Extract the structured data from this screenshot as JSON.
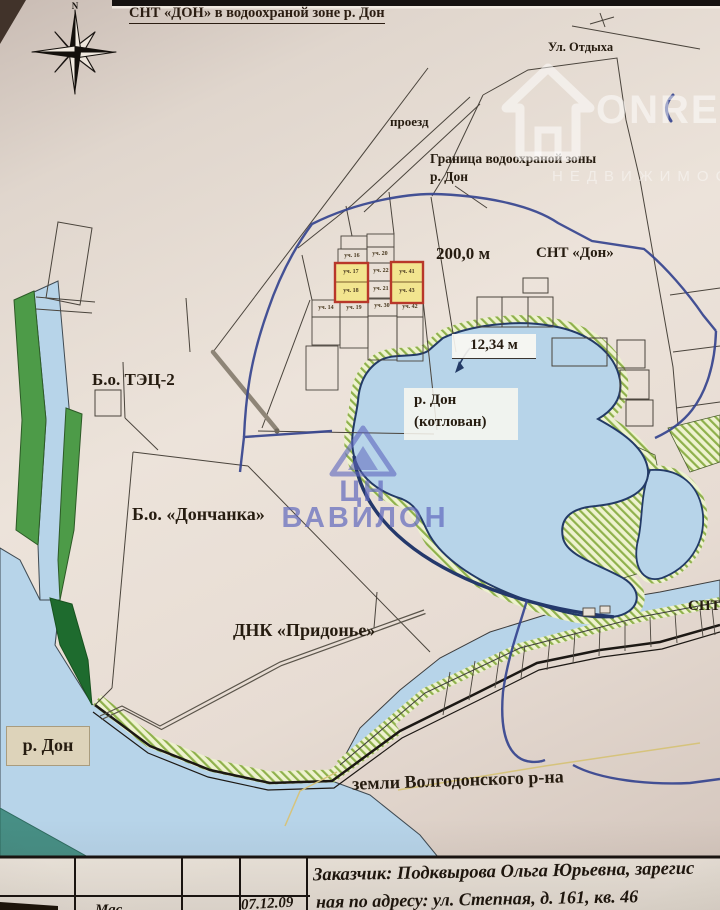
{
  "page": {
    "title": "СНТ «ДОН» в водоохраной зоне р. Дон"
  },
  "compass": {
    "north": "N"
  },
  "watermarks": {
    "onrealt_brand": "ONREALT",
    "onrealt_subtitle": "НЕДВИЖИМОСТЬ",
    "vavilon_top": "ЦН",
    "vavilon_bottom": "ВАВИЛОН"
  },
  "labels": {
    "street": "Ул. Отдыха",
    "passage": "проезд",
    "boundary_line1": "Граница водоохраной зоны",
    "boundary_line2": "р. Дон",
    "distance": "200,0 м",
    "snt_don": "СНТ «Дон»",
    "depth": "12,34 м",
    "pond_line1": "р. Дон",
    "pond_line2": "(котлован)",
    "base_tec": "Б.о. ТЭЦ-2",
    "base_donchanka": "Б.о. «Дончанка»",
    "dnk_pridonye": "ДНК «Придонье»",
    "snt_right_edge": "СНТ",
    "river_don": "р. Дон",
    "volgodonsk_lands": "земли Волгодонского р-на"
  },
  "plots": {
    "p16": "уч. 16",
    "p20": "уч. 20",
    "p17": "уч. 17",
    "p22": "уч. 22",
    "p41": "уч. 41",
    "p18": "уч. 18",
    "p21": "уч. 21",
    "p43": "уч. 43",
    "p14": "уч. 14",
    "p19": "уч. 19",
    "p30": "уч. 30",
    "p42": "уч. 42"
  },
  "footer": {
    "customer_line1": "Заказчик: Подквырова Ольга Юрьевна, зарегис",
    "customer_line2": "ная по адресу: ул. Степная, д. 161, кв. 46",
    "date": "07.12.09",
    "scale_fragment": "Мас"
  },
  "colors": {
    "water": "#b7d4e9",
    "greenbelt": "#4d9b48",
    "hatch_line": "#8fb14c",
    "protection_boundary": "#35448f",
    "highlight_fill": "#f2e58f",
    "highlight_border": "#b8372a"
  }
}
